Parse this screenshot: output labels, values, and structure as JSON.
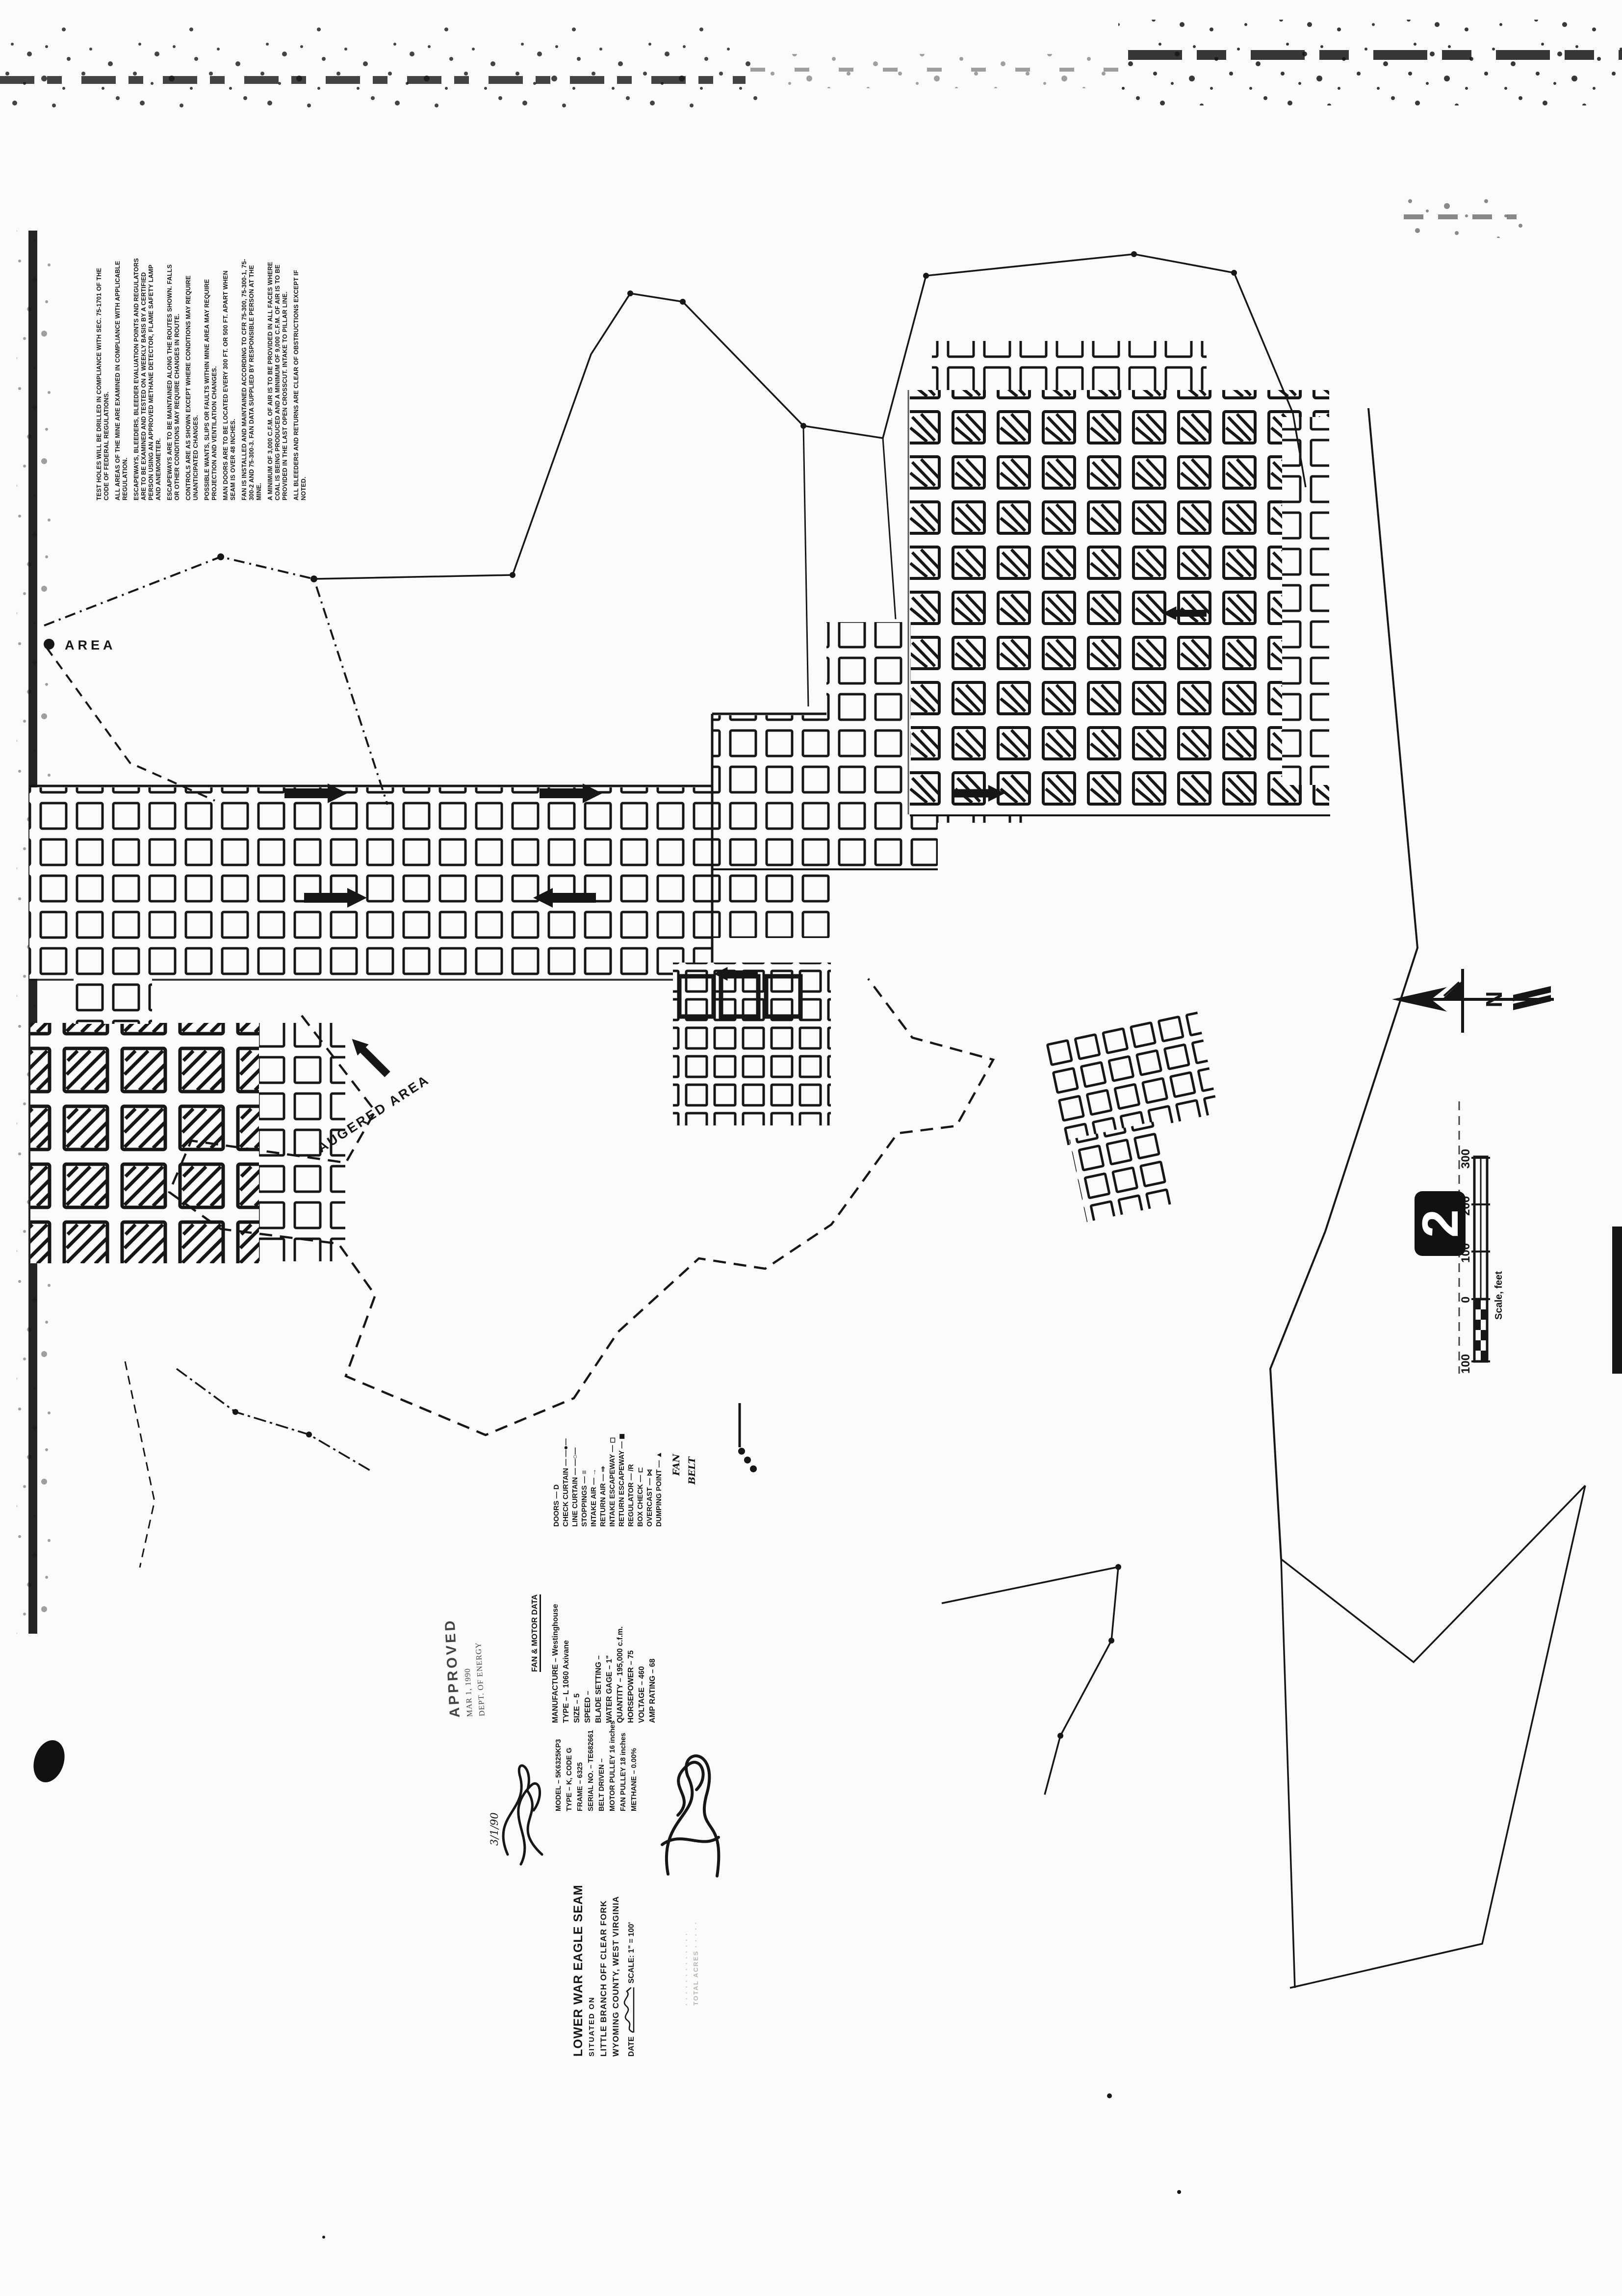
{
  "document": {
    "kind": "scanned mine ventilation map",
    "sheet_number": "2",
    "north_label": "N"
  },
  "map_labels": {
    "area_partial": "AREA",
    "augered_area": "AUGERED AREA"
  },
  "notes": {
    "items": [
      "TEST HOLES WILL BE DRILLED IN COMPLIANCE WITH SEC. 75-1701 OF THE CODE OF FEDERAL REGULATIONS.",
      "ALL AREAS OF THE MINE ARE EXAMINED IN COMPLIANCE WITH APPLICABLE REGULATION.",
      "ESCAPEWAYS, BLEEDERS, BLEEDER EVALUATION POINTS AND REGULATORS ARE TO BE EXAMINED AND TESTED ON A WEEKLY BASIS BY A CERTIFIED PERSON USING AN APPROVED METHANE DETECTOR, FLAME SAFETY LAMP AND ANEMOMETER.",
      "ESCAPEWAYS ARE TO BE MAINTAINED ALONG THE ROUTES SHOWN.  FALLS OR OTHER CONDITIONS MAY REQUIRE CHANGES IN ROUTE.",
      "CONTROLS ARE AS SHOWN EXCEPT WHERE CONDITIONS MAY REQUIRE UNANTICIPATED CHANGES.",
      "POSSIBLE WANTS, SLIPS OR FAULTS WITHIN MINE AREA MAY REQUIRE PROJECTION AND VENTILATION CHANGES.",
      "MAN DOORS ARE TO BE LOCATED EVERY 300 FT. OR 500 FT. APART WHEN SEAM IS OVER 48 INCHES.",
      "FAN IS INSTALLED AND MAINTAINED ACCORDING TO CFR 75-300, 75-300-1, 75-300-2 AND 75-300-3.  FAN DATA SUPPLIED BY RESPONSIBLE PERSON AT THE MINE.",
      "A MINIMUM OF 3,000 C.F.M. OF AIR IS TO BE PROVIDED IN ALL FACES WHERE COAL IS BEING PRODUCED AND A MINIMUM OF 9,000 C.F.M. OF AIR IS TO BE PROVIDED IN THE LAST OPEN CROSSCUT.  INTAKE TO PILLAR LINE.",
      "ALL BLEEDERS AND RETURNS ARE CLEAR OF OBSTRUCTIONS EXCEPT IF NOTED."
    ]
  },
  "legend": {
    "items": [
      "DOORS — D",
      "CHECK CURTAIN — —●—",
      "LINE CURTAIN — —○—",
      "STOPPINGS — ≡",
      "INTAKE AIR — →",
      "RETURN AIR — ⇒",
      "INTAKE ESCAPEWAY — ◻",
      "RETURN ESCAPEWAY — ◼",
      "REGULATOR — /R",
      "BOX CHECK — ⊏",
      "OVERCAST — ⋈",
      "DUMPING POINT — ▲"
    ],
    "handwritten_fan": "FAN",
    "handwritten_belt": "BELT"
  },
  "fan_motor_data": {
    "title": "FAN & MOTOR DATA",
    "items": [
      "MANUFACTURE – Westinghouse",
      "TYPE – L 1060 Axivane",
      "SIZE – 5",
      "SPEED –",
      "BLADE SETTING –",
      "WATER GAGE – 1\"",
      "QUANTITY – 195,000 c.f.m.",
      "HORSEPOWER – 75",
      "VOLTAGE – 460",
      "AMP RATING – 68"
    ]
  },
  "motor_model": {
    "items": [
      "MODEL – 5K6325KP3",
      "TYPE – K, CODE G",
      "FRAME – 6325",
      "SERIAL NO. – TE682661",
      "BELT DRIVEN –",
      "MOTOR PULLEY 16 inches",
      "FAN PULLEY 18 inches",
      "METHANE – 0.00%"
    ]
  },
  "approval_stamp": {
    "line1": "APPROVED",
    "line2": "MAR 1, 1990",
    "line3": "DEPT. OF ENERGY"
  },
  "signatures": {
    "handwritten_date": "3/1/90"
  },
  "title_block": {
    "seam": "LOWER WAR EAGLE SEAM",
    "situated": "SITUATED ON",
    "branch": "LITTLE BRANCH OFF CLEAR FORK",
    "county": "WYOMING COUNTY, WEST VIRGINIA",
    "date_label": "DATE",
    "scale_label": "SCALE: 1\" = 100'",
    "faint_line1": "· · · ·  · · · ·  · · · · ·",
    "faint_line2": "TOTAL ACRES · · · · ·"
  },
  "scale_bar": {
    "ticks": [
      "300",
      "200",
      "100",
      "0",
      "100"
    ],
    "caption": "Scale, feet"
  },
  "colors": {
    "ink": "#161616",
    "paper": "#fbfbf9",
    "faint": "#b7b7b5"
  }
}
